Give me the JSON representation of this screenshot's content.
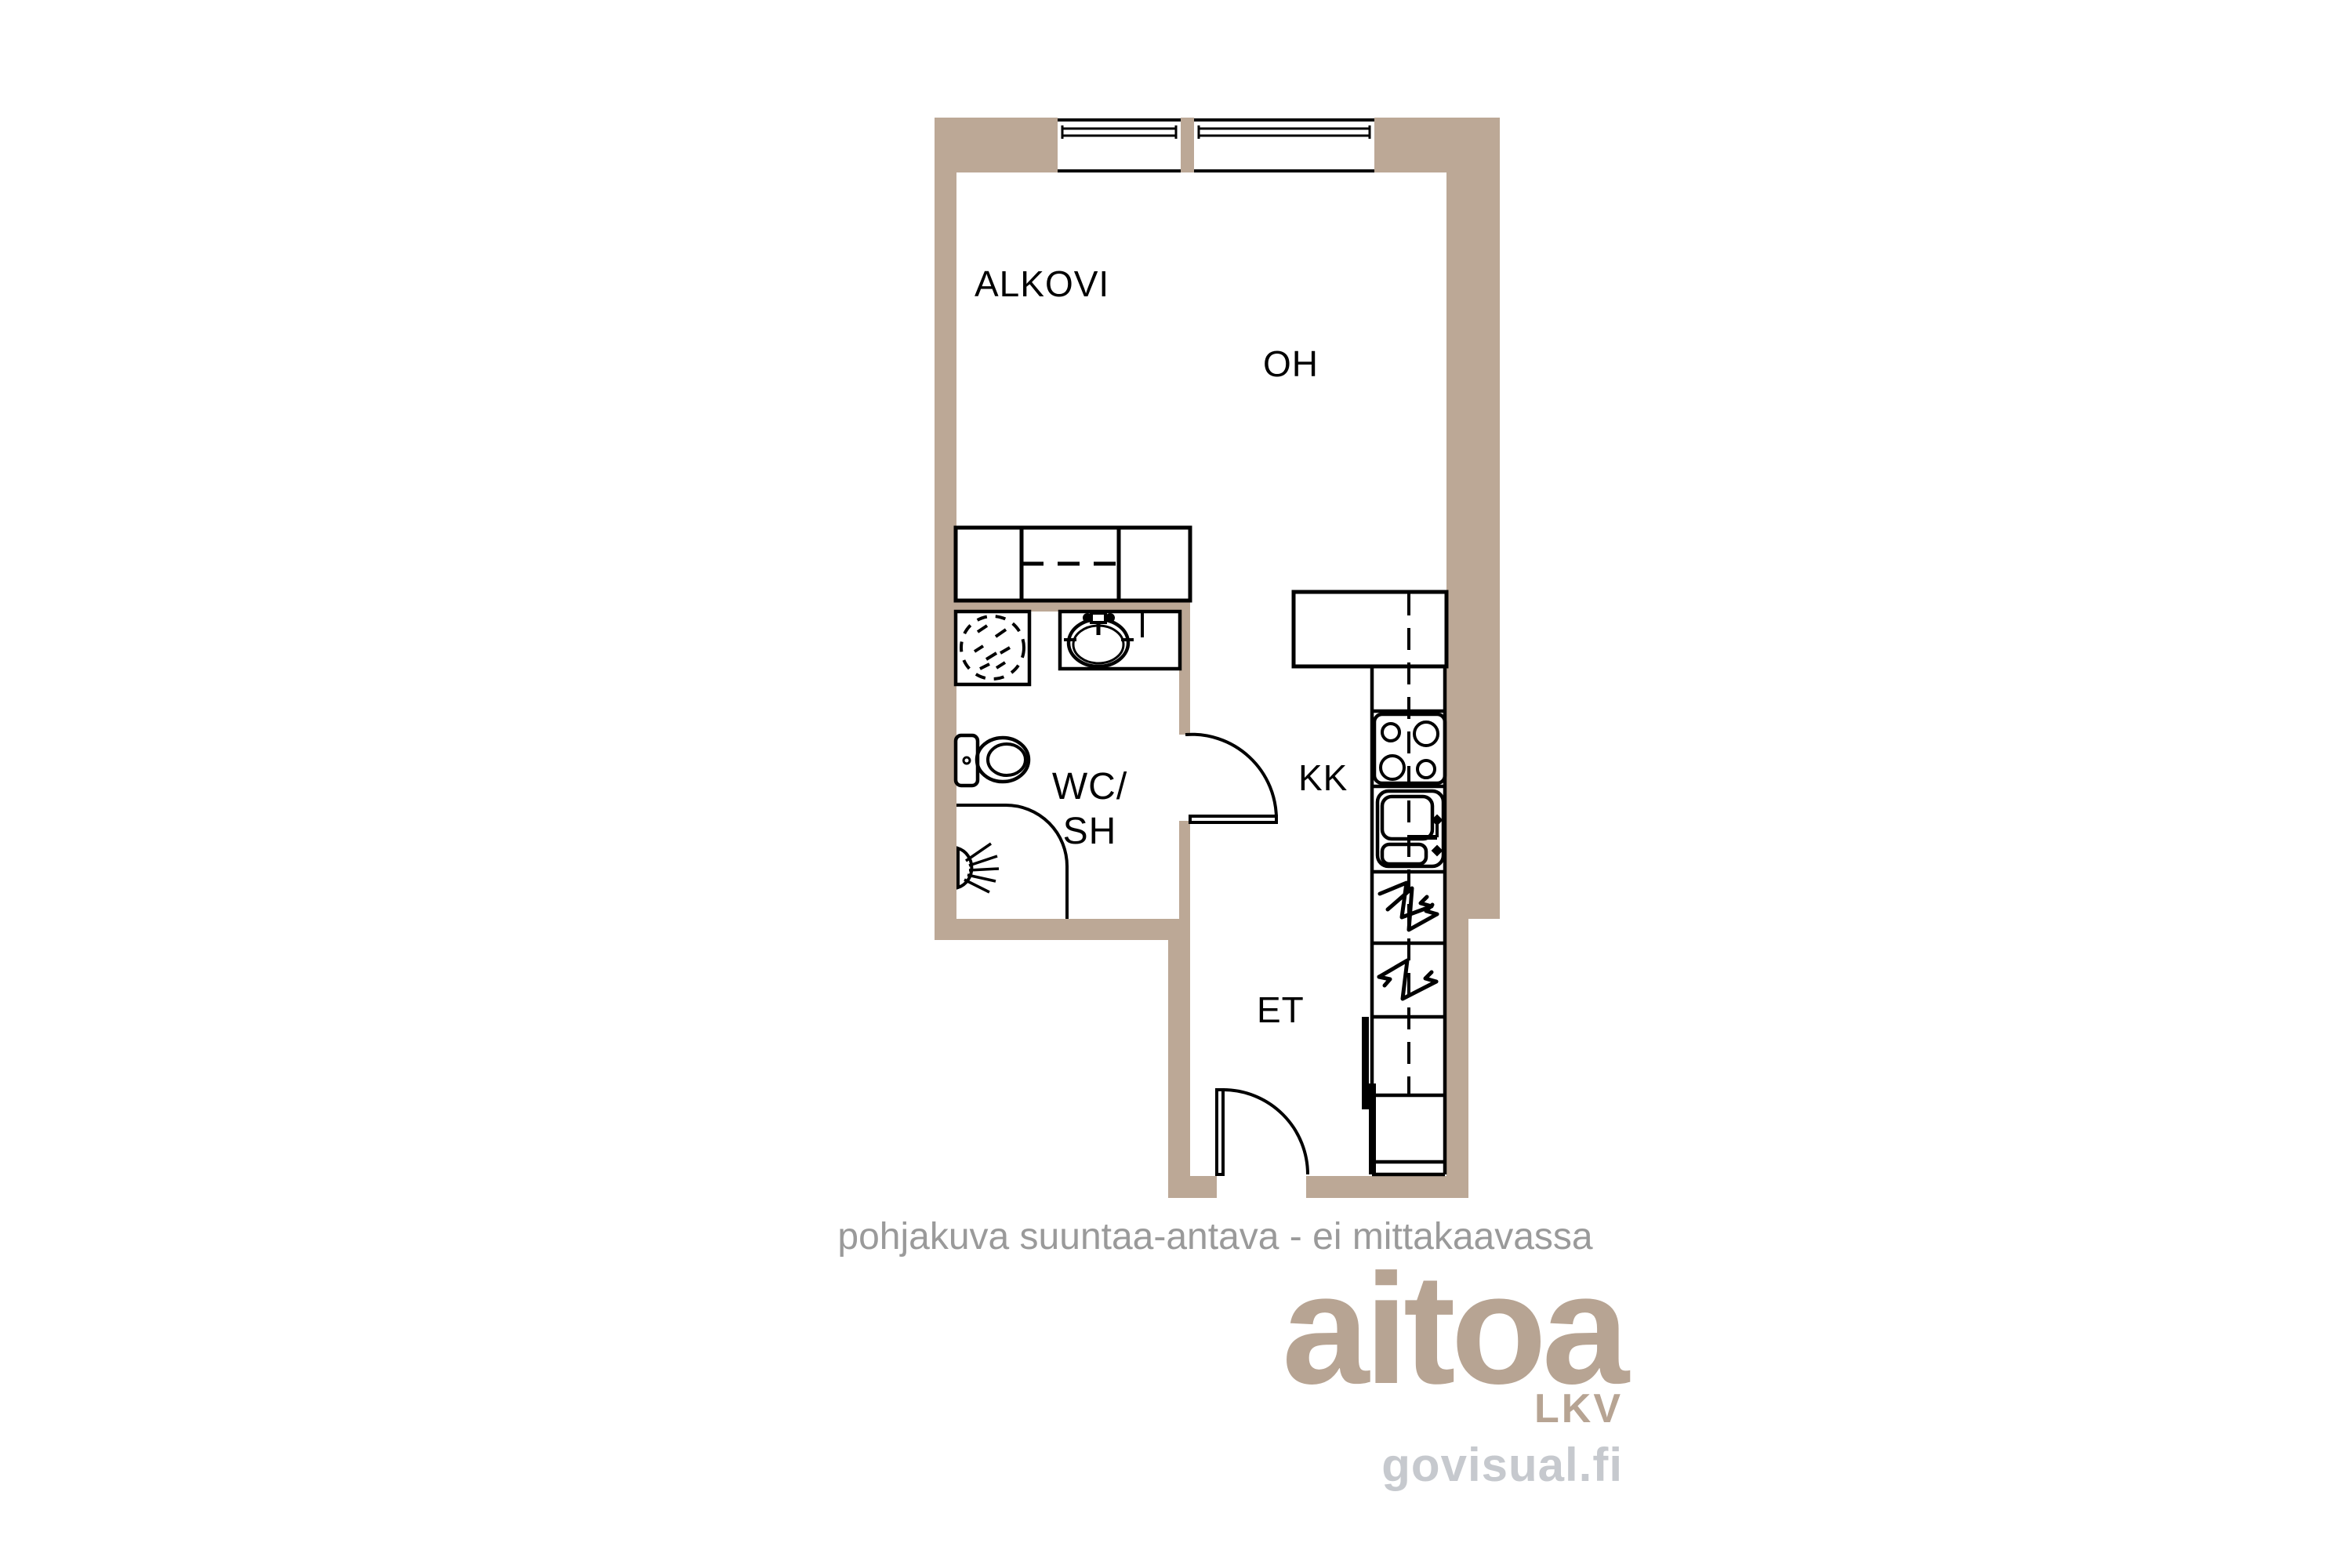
{
  "plan": {
    "rooms": {
      "alkovi": {
        "label": "ALKOVI"
      },
      "oh": {
        "label": "OH"
      },
      "wc_sh": {
        "label_line1": "WC/",
        "label_line2": "SH"
      },
      "kk": {
        "label": "KK"
      },
      "et": {
        "label": "ET"
      }
    },
    "disclaimer": "pohjakuva suuntaa-antava - ei mittakaavassa",
    "icons": {
      "window": "window-icon",
      "closet": "closet-icon",
      "washing_machine": "washing-machine-icon",
      "vanity_sink": "bathroom-sink-icon",
      "toilet": "toilet-icon",
      "shower": "shower-icon",
      "shower_head": "shower-head-icon",
      "wc_door": "door-swing-icon",
      "entry_door": "door-swing-icon",
      "kitchen_counter": "kitchen-counter-icon",
      "stove": "stove-icon",
      "kitchen_sink": "kitchen-sink-icon",
      "appliance_bolt": "electrical-appliance-icon",
      "fridge": "fridge-reservation-icon"
    }
  },
  "branding": {
    "logo": "aitoa",
    "logo_sub": "LKV",
    "credit": "govisual.fi"
  },
  "colors": {
    "wall": "#bca896",
    "line": "#000000",
    "label": "#000000",
    "disclaimer_gray": "#9a9a9a",
    "logo_beige": "#b7a493",
    "credit_gray": "#c6c9ce"
  }
}
